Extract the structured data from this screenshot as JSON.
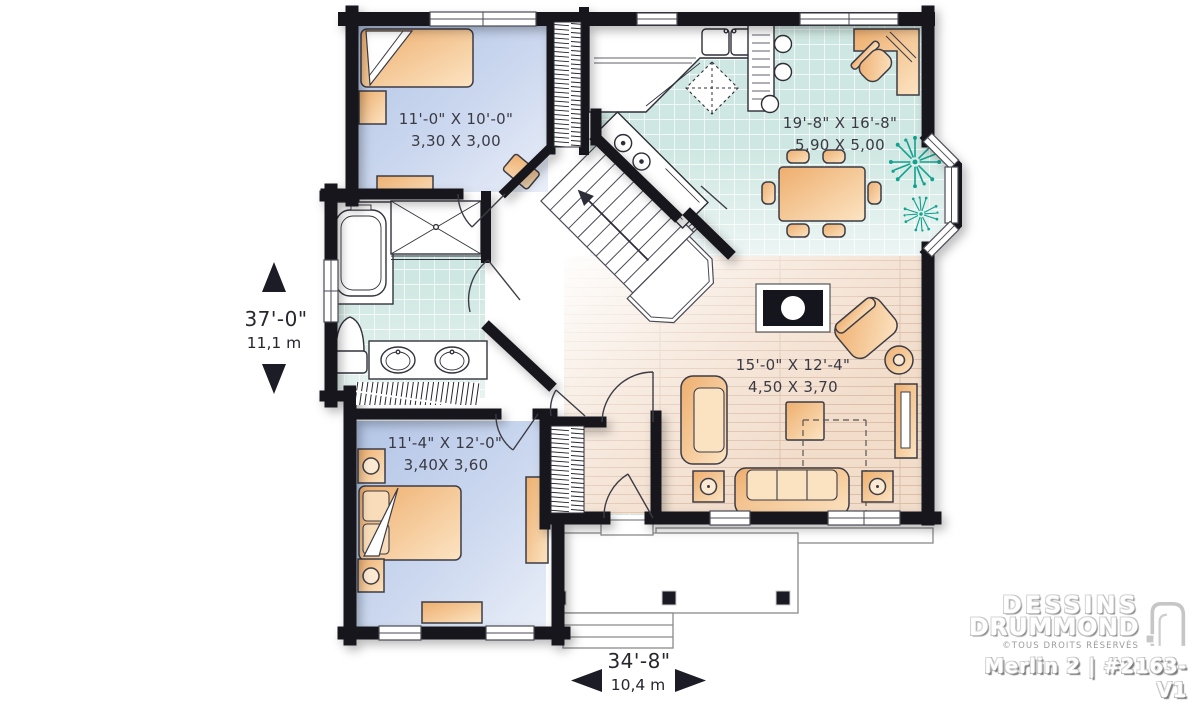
{
  "plan_labels": {
    "bedroom1": {
      "imperial": "11'-0\" X 10'-0\"",
      "metric": "3,30 X 3,00"
    },
    "kitchen_dining": {
      "imperial": "19'-8\" X 16'-8\"",
      "metric": "5,90 X 5,00"
    },
    "living_room": {
      "imperial": "15'-0\" X 12'-4\"",
      "metric": "4,50 X 3,70"
    },
    "bedroom2": {
      "imperial": "11'-4\" X 12'-0\"",
      "metric": "3,40X 3,60"
    }
  },
  "overall_dimensions": {
    "depth_imperial": "37'-0\"",
    "depth_metric": "11,1 m",
    "width_imperial": "34'-8\"",
    "width_metric": "10,4 m"
  },
  "branding": {
    "name_line1": "DESSINS",
    "name_line2": "DRUMMOND",
    "rights": "©TOUS DROITS RÉSERVÉS",
    "model": "Merlin 2 | #2163-V1"
  },
  "colors": {
    "wall": "#17171f",
    "tile_floor": "#cfe7e2",
    "bedroom_floor": "#b9c9e9",
    "wood_floor": "#f2ddcb",
    "furniture": "#f3bc83",
    "plant": "#12a290",
    "label_text": "#3a3a45"
  }
}
